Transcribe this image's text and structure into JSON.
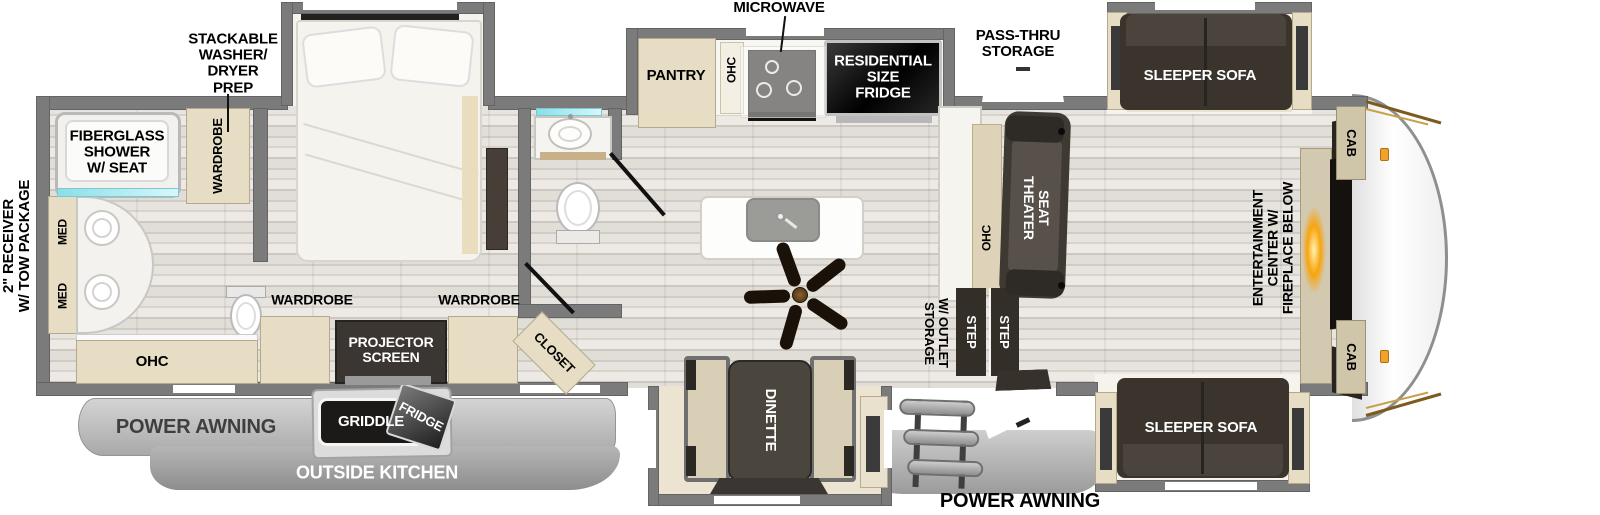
{
  "colors": {
    "wall": "#7b7b7b",
    "cabinet": "#e6ddc4",
    "dark_furniture": "#3e3831",
    "fireplace_glow": "#f7a40f",
    "handle_accent": "#f0a22c",
    "glass_teal": "#9fdde6",
    "awning_gray": "#b5b5b5"
  },
  "rear_bath": {
    "receiver": "2\" RECEIVER\nW/ TOW PACKAGE",
    "washer_prep": "STACKABLE\nWASHER/\nDRYER\nPREP",
    "shower": "FIBERGLASS\nSHOWER\nW/ SEAT",
    "wardrobe": "WARDROBE",
    "med_top": "MED",
    "med_bottom": "MED",
    "ohc": "OHC"
  },
  "bedroom": {
    "wardrobe_left": "WARDROBE",
    "wardrobe_right": "WARDROBE",
    "projector": "PROJECTOR\nSCREEN",
    "closet": "CLOSET"
  },
  "kitchen": {
    "microwave": "MICROWAVE",
    "pantry": "PANTRY",
    "ohc": "OHC",
    "residential_fridge": "RESIDENTIAL\nSIZE\nFRIDGE",
    "counter_ohc": "OHC"
  },
  "living": {
    "pass_thru": "PASS-THRU\nSTORAGE",
    "sofa_top": "SLEEPER SOFA",
    "sofa_bottom": "SLEEPER SOFA",
    "theater_seat": "THEATER\nSEAT",
    "entertainment": "ENTERTAINMENT\nCENTER W/\nFIREPLACE BELOW",
    "cab_top": "CAB",
    "cab_bottom": "CAB",
    "storage_outlet": "STORAGE\nW/ OUTLET",
    "step_1": "STEP",
    "step_2": "STEP"
  },
  "dinette": {
    "table": "DINETTE"
  },
  "exterior": {
    "awning_left": "POWER AWNING",
    "awning_right": "POWER AWNING",
    "outside_kitchen": "OUTSIDE KITCHEN",
    "griddle": "GRIDDLE",
    "fridge": "FRIDGE"
  }
}
